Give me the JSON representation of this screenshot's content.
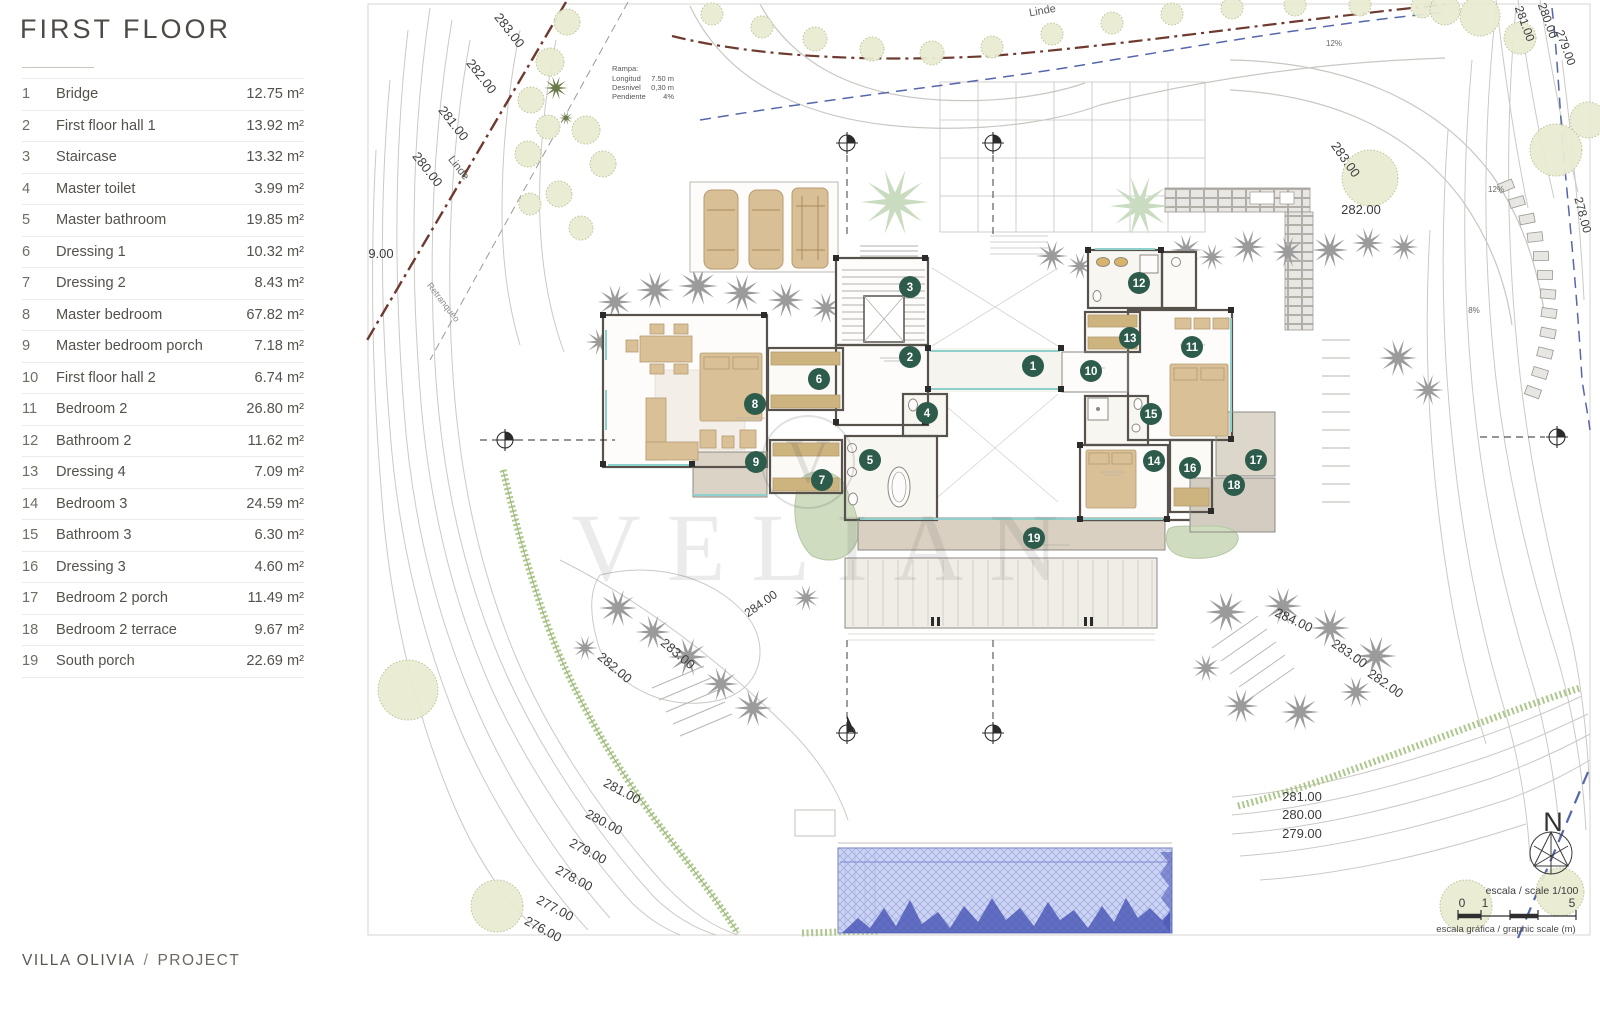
{
  "panel": {
    "title": "FIRST FLOOR",
    "legend": [
      {
        "num": "1",
        "name": "Bridge",
        "area": "12.75 m²"
      },
      {
        "num": "2",
        "name": "First floor hall 1",
        "area": "13.92 m²"
      },
      {
        "num": "3",
        "name": "Staircase",
        "area": "13.32 m²"
      },
      {
        "num": "4",
        "name": "Master toilet",
        "area": "3.99 m²"
      },
      {
        "num": "5",
        "name": "Master bathroom",
        "area": "19.85 m²"
      },
      {
        "num": "6",
        "name": "Dressing 1",
        "area": "10.32 m²"
      },
      {
        "num": "7",
        "name": "Dressing 2",
        "area": "8.43 m²"
      },
      {
        "num": "8",
        "name": "Master bedroom",
        "area": "67.82 m²"
      },
      {
        "num": "9",
        "name": "Master bedroom porch",
        "area": "7.18 m²"
      },
      {
        "num": "10",
        "name": "First floor hall 2",
        "area": "6.74 m²"
      },
      {
        "num": "11",
        "name": "Bedroom 2",
        "area": "26.80 m²"
      },
      {
        "num": "12",
        "name": "Bathroom 2",
        "area": "11.62 m²"
      },
      {
        "num": "13",
        "name": "Dressing 4",
        "area": "7.09 m²"
      },
      {
        "num": "14",
        "name": "Bedroom 3",
        "area": "24.59 m²"
      },
      {
        "num": "15",
        "name": "Bathroom 3",
        "area": "6.30 m²"
      },
      {
        "num": "16",
        "name": "Dressing 3",
        "area": "4.60 m²"
      },
      {
        "num": "17",
        "name": "Bedroom 2 porch",
        "area": "11.49 m²"
      },
      {
        "num": "18",
        "name": "Bedroom 2 terrace",
        "area": "9.67 m²"
      },
      {
        "num": "19",
        "name": "South porch",
        "area": "22.69 m²"
      }
    ],
    "footer": {
      "project_name": "VILLA OLIVIA",
      "separator": "/",
      "section": "PROJECT"
    }
  },
  "drawing": {
    "watermark": {
      "letter": "V",
      "word": "VELIAN"
    },
    "north_label": "N",
    "scale": {
      "line1": "escala / scale 1/100",
      "ticks": [
        "0",
        "1",
        "5"
      ],
      "line2": "escala gráfica / graphic scale (m)"
    },
    "ramp_note": {
      "title": "Rampa:",
      "rows": [
        [
          "Longitud",
          "7.50 m"
        ],
        [
          "Desnivel",
          "0,30 m"
        ],
        [
          "Pendiente",
          "4%"
        ]
      ]
    },
    "markers": [
      {
        "n": "1",
        "x": 1033,
        "y": 366
      },
      {
        "n": "2",
        "x": 910,
        "y": 357
      },
      {
        "n": "3",
        "x": 910,
        "y": 287
      },
      {
        "n": "4",
        "x": 927,
        "y": 413
      },
      {
        "n": "5",
        "x": 870,
        "y": 460
      },
      {
        "n": "6",
        "x": 819,
        "y": 379
      },
      {
        "n": "7",
        "x": 822,
        "y": 480
      },
      {
        "n": "8",
        "x": 755,
        "y": 404
      },
      {
        "n": "9",
        "x": 756,
        "y": 462
      },
      {
        "n": "10",
        "x": 1091,
        "y": 371
      },
      {
        "n": "11",
        "x": 1192,
        "y": 347
      },
      {
        "n": "12",
        "x": 1139,
        "y": 283
      },
      {
        "n": "13",
        "x": 1130,
        "y": 338
      },
      {
        "n": "14",
        "x": 1154,
        "y": 461
      },
      {
        "n": "15",
        "x": 1151,
        "y": 414
      },
      {
        "n": "16",
        "x": 1190,
        "y": 468
      },
      {
        "n": "17",
        "x": 1256,
        "y": 460
      },
      {
        "n": "18",
        "x": 1234,
        "y": 485
      },
      {
        "n": "19",
        "x": 1034,
        "y": 538
      }
    ],
    "labels": [
      [
        "283.00",
        506,
        33,
        52,
        13
      ],
      [
        "282.00",
        478,
        79,
        52,
        13
      ],
      [
        "281.00",
        450,
        126,
        52,
        13
      ],
      [
        "280.00",
        424,
        172,
        52,
        13
      ],
      [
        "Linde",
        456,
        170,
        52,
        11,
        "#5a5a5a"
      ],
      [
        "9.00",
        381,
        258,
        0,
        13
      ],
      [
        "Retranqueo",
        441,
        304,
        52,
        9,
        "#8b8b8b"
      ],
      [
        "Linde",
        1043,
        14,
        -10,
        11,
        "#5a5a5a"
      ],
      [
        "281.00",
        1521,
        25,
        70,
        12
      ],
      [
        "280.00",
        1544,
        22,
        70,
        12
      ],
      [
        "279.00",
        1562,
        49,
        70,
        12
      ],
      [
        "278.00",
        1579,
        216,
        75,
        12
      ],
      [
        "12%",
        1496,
        192,
        0,
        8,
        "#666666"
      ],
      [
        "12%",
        1334,
        46,
        0,
        8,
        "#666666"
      ],
      [
        "8%",
        1474,
        313,
        0,
        8,
        "#666666"
      ],
      [
        "283.00",
        1342,
        162,
        55,
        13
      ],
      [
        "282.00",
        1361,
        214,
        0,
        13
      ],
      [
        "282.00",
        612,
        671,
        40,
        13
      ],
      [
        "283.00",
        675,
        657,
        40,
        13
      ],
      [
        "281.00",
        620,
        795,
        28,
        13
      ],
      [
        "280.00",
        602,
        826,
        28,
        13
      ],
      [
        "279.00",
        586,
        855,
        28,
        13
      ],
      [
        "278.00",
        572,
        882,
        28,
        13
      ],
      [
        "277.00",
        553,
        912,
        28,
        13
      ],
      [
        "276.00",
        541,
        933,
        28,
        13
      ],
      [
        "284.00",
        763,
        607,
        -35,
        12
      ],
      [
        "284.00",
        1292,
        624,
        25,
        13
      ],
      [
        "283.00",
        1347,
        657,
        35,
        13
      ],
      [
        "282.00",
        1383,
        687,
        35,
        13
      ],
      [
        "281.00",
        1302,
        801,
        0,
        13
      ],
      [
        "280.00",
        1302,
        819,
        0,
        13
      ],
      [
        "279.00",
        1302,
        838,
        0,
        13
      ]
    ]
  },
  "colors": {
    "marker_green": "#2e5c4c",
    "label_text": "#3c3c3c",
    "boundary_maroon": "#6e3a30",
    "utility_blue": "#5566aa",
    "glass_teal": "#8ed1cc",
    "pool_blue": "#ccd4f2",
    "pool_dark": "#3f4cb0",
    "hedge_green": "#adc78c"
  }
}
